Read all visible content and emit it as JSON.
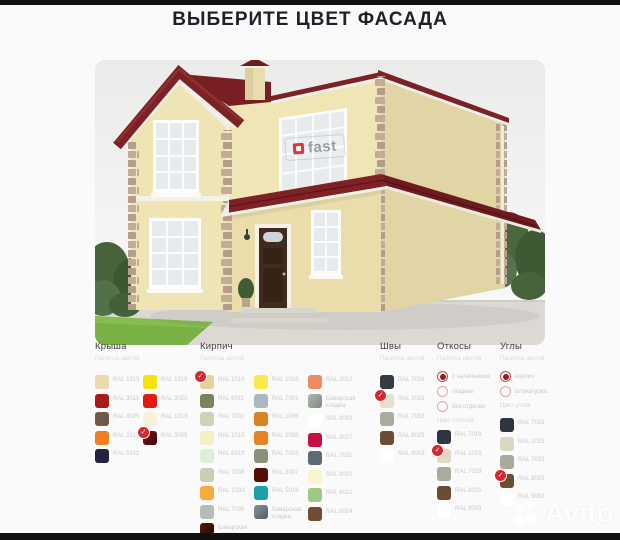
{
  "title": "ВЫБЕРИТЕ ЦВЕТ ФАСАДА",
  "house": {
    "watermark": "fast"
  },
  "brand": {
    "watermark": "Avito"
  },
  "palette": {
    "check_color": "#d7282f",
    "columns": [
      {
        "id": "roof",
        "label": "Крыша",
        "subtitle": "Палитра цветов",
        "groups": [
          {
            "swatches": [
              {
                "color": "#ecd9ab",
                "label": "RAL 1015"
              },
              {
                "color": "#ab1a17",
                "label": "RAL 3011"
              },
              {
                "color": "#6f5a48",
                "label": "RAL 8025"
              },
              {
                "color": "#f07d1f",
                "label": "RAL 2011"
              },
              {
                "color": "#222340",
                "label": "RAL 5011"
              }
            ]
          },
          {
            "swatches": [
              {
                "color": "#f8e201",
                "label": "RAL 1018"
              },
              {
                "color": "#e01b16",
                "label": "RAL 3020"
              },
              {
                "color": "#f8f1d8",
                "label": "RAL 1013"
              },
              {
                "gradient": [
                  "#7a1612",
                  "#3f0604"
                ],
                "label": "RAL 3005",
                "checked": true
              }
            ]
          }
        ]
      },
      {
        "id": "brick",
        "label": "Кирпич",
        "subtitle": "Палитра цветов",
        "groups": [
          {
            "swatches": [
              {
                "color": "#e7d09c",
                "label": "RAL 1014",
                "checked": true
              },
              {
                "color": "#77855e",
                "label": "RAL 6011"
              },
              {
                "color": "#d0d2b7",
                "label": "RAL 7032"
              },
              {
                "color": "#f6eec5",
                "label": "RAL 1015"
              },
              {
                "color": "#dbefd7",
                "label": "RAL 6019"
              },
              {
                "color": "#c9cdb6",
                "label": "RAL 7038"
              },
              {
                "color": "#f7aa3d",
                "label": "RAL 1033"
              },
              {
                "color": "#b6bdb6",
                "label": "RAL 7035"
              },
              {
                "gradient": [
                  "#56190a",
                  "#260900"
                ],
                "label": "Баварская",
                "label2": "кладка"
              }
            ]
          },
          {
            "swatches": [
              {
                "color": "#f9e94b",
                "label": "RAL 1016"
              },
              {
                "color": "#a9b9bf",
                "label": "RAL 7001"
              },
              {
                "color": "#d78524",
                "label": "RAL 1006"
              },
              {
                "color": "#e8811f",
                "label": "RAL 2008"
              },
              {
                "color": "#8b927a",
                "label": "RAL 7003"
              },
              {
                "color": "#531009",
                "label": "RAL 3007"
              },
              {
                "color": "#1ca1a6",
                "label": "RAL 5018"
              },
              {
                "gradient": [
                  "#8a949c",
                  "#525d66"
                ],
                "label": "Баварская",
                "label2": "кладка"
              }
            ]
          },
          {
            "swatches": [
              {
                "color": "#f08a63",
                "label": "RAL 2012"
              },
              {
                "gradient": [
                  "#aeb6ae",
                  "#7f877f"
                ],
                "label": "Баварская",
                "label2": "кладка"
              },
              {
                "color": "#ffffff",
                "label": "RAL 9003"
              },
              {
                "color": "#c51141",
                "label": "RAL 3027"
              },
              {
                "color": "#5f6a76",
                "label": "RAL 7031"
              },
              {
                "color": "#f8f4cf",
                "label": "RAL 9001"
              },
              {
                "color": "#9eca80",
                "label": "RAL 6021"
              },
              {
                "color": "#6f4c35",
                "label": "RAL 8024"
              }
            ]
          }
        ]
      },
      {
        "id": "seams",
        "label": "Швы",
        "subtitle": "Палитра цветов",
        "groups": [
          {
            "swatches": [
              {
                "color": "#353b42",
                "label": "RAL 7016"
              },
              {
                "color": "#e5dfcc",
                "label": "RAL 1015",
                "checked": true
              },
              {
                "color": "#aaaa9e",
                "label": "RAL 7033"
              },
              {
                "color": "#6d4c36",
                "label": "RAL 8025"
              },
              {
                "color": "#ffffff",
                "label": "RAL 9003"
              }
            ]
          }
        ]
      },
      {
        "id": "slopes",
        "label": "Откосы",
        "subtitle": "Палитра цветов",
        "radios": [
          {
            "label": "с наличником",
            "selected": true
          },
          {
            "label": "гладкие",
            "selected": false
          },
          {
            "label": "без отделки",
            "selected": false
          }
        ],
        "note": "Цвет откосов",
        "groups": [
          {
            "swatches": [
              {
                "color": "#30363f",
                "label": "RAL 7016"
              },
              {
                "color": "#dfd9c6",
                "label": "RAL 1015",
                "checked": true
              },
              {
                "color": "#aaaa9e",
                "label": "RAL 7033"
              },
              {
                "color": "#6d4c36",
                "label": "RAL 8025"
              },
              {
                "color": "#ffffff",
                "label": "RAL 9003"
              }
            ]
          }
        ]
      },
      {
        "id": "corners",
        "label": "Углы",
        "subtitle": "Палитра цветов",
        "radios": [
          {
            "label": "кирпич",
            "selected": true
          },
          {
            "label": "штукатурка",
            "selected": false
          }
        ],
        "note": "Цвет углов",
        "groups": [
          {
            "swatches": [
              {
                "color": "#2f3540",
                "label": "RAL 7016"
              },
              {
                "color": "#dad7c3",
                "label": "RAL 1015"
              },
              {
                "color": "#a9a99d",
                "label": "RAL 7033"
              },
              {
                "color": "#6d4c36",
                "label": "RAL 8025",
                "checked": true
              },
              {
                "color": "#ffffff",
                "label": "RAL 9003"
              }
            ]
          }
        ]
      }
    ]
  }
}
